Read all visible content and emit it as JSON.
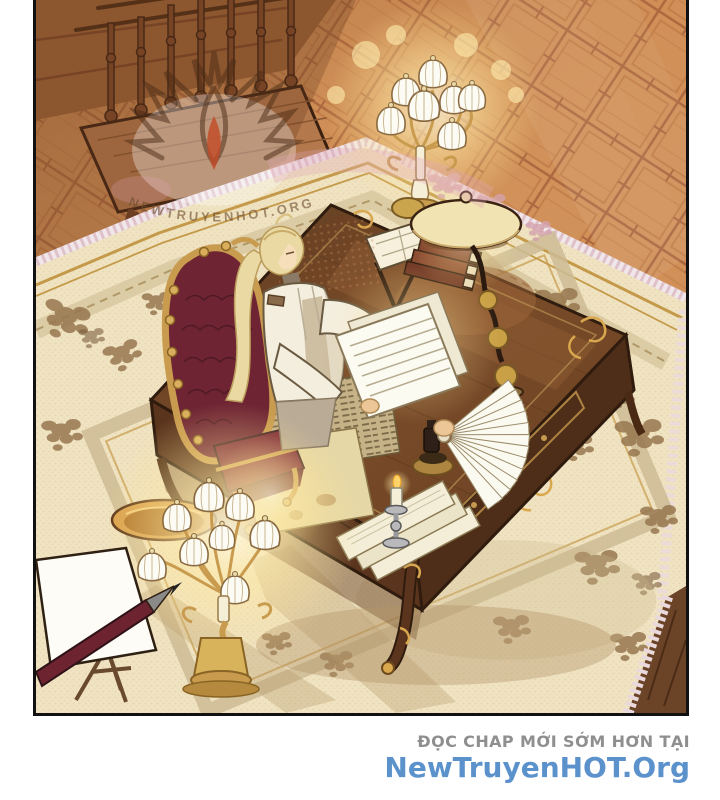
{
  "page": {
    "kind": "webtoon-comic-panel"
  },
  "footer": {
    "tagline": "ĐỌC CHAP MỚI SỚM HƠN TẠI",
    "tagline_color": "#8f8f8f",
    "site": "NewTruyenHOT.Org",
    "site_color": "#5b92cc"
  },
  "watermark": {
    "icon": "flame-logo",
    "text": "NEWTRUYENHOT.ORG",
    "accent_color": "#c24a26"
  },
  "scene": {
    "description": "A blonde character in a white coat sits on a gold-framed red tufted chair at a large ornate wooden desk, reading a fanned sheaf of documents in a candle-lit study with a parquet floor and a patterned cream carpet.",
    "objects": [
      "wooden service cart with spindles and spoked wheels",
      "glowing floor candelabra with white shades (top)",
      "glowing floor candelabra with white shades (bottom left)",
      "gilded round side table",
      "ornate writing desk with gold ormolu mounts",
      "red tufted throne chair",
      "blonde character reading documents",
      "dome desk lamp",
      "stack of books and reading stand",
      "aged newspaper and stained map",
      "stack of cream papers",
      "lit candlestick",
      "ink lamp",
      "easel with canvas and oversized pencil"
    ],
    "palette": {
      "floor": "#cf8e56",
      "floor_line": "#a7613a",
      "carpet": "#f0e3c2",
      "carpet_motif": "#96764f",
      "carpet_gold": "#c49a4a",
      "desk_wood": "#6a4123",
      "chair_red": "#6e2433",
      "gold": "#c89b4e",
      "glow": "#ffeaa6",
      "outline": "#2f1c0e"
    }
  }
}
